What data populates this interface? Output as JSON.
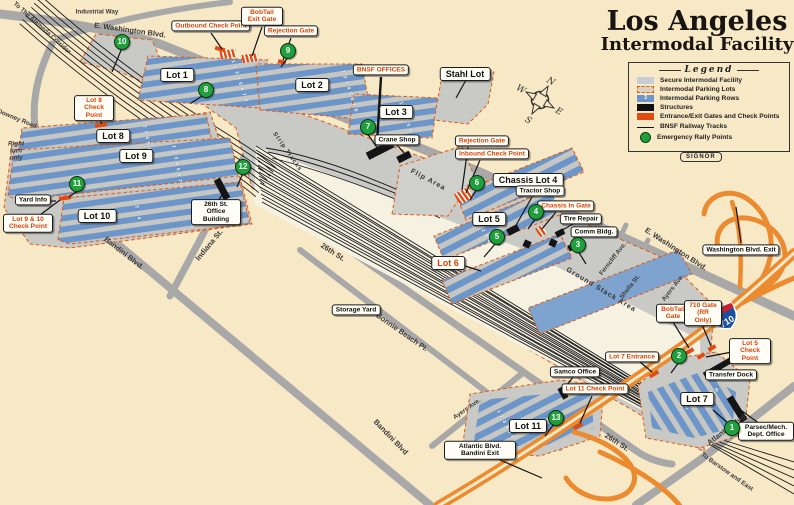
{
  "title": {
    "line1": "Los Angeles",
    "line2": "Intermodal Facility"
  },
  "legend": {
    "heading": "Legend",
    "badge": "SIGNOR",
    "items": [
      {
        "label": "Secure Intermodal Facility"
      },
      {
        "label": "Intermodal Parking Lots"
      },
      {
        "label": "Intermodal Parking Rows",
        "swatch_text": "3"
      },
      {
        "label": "Structures"
      },
      {
        "label": "Entrance/Exit Gates and Check Points"
      },
      {
        "label": "BNSF Railway Tracks"
      },
      {
        "label": "Emergency Rally Points"
      }
    ]
  },
  "compass": {
    "n": "N",
    "e": "E",
    "s": "S",
    "w": "W"
  },
  "freeway": {
    "shield": "710"
  },
  "streets": {
    "washington_top": "E. Washington Blvd.",
    "washington_right": "E. Washington Blvd.",
    "industrial_way": "Industrial Way",
    "downey": "Downey Road",
    "alameda": "To The Alameda Corridor",
    "bandini_left": "Bandini Blvd.",
    "bandini_bottom": "Bandini Blvd",
    "indiana": "Indiana St.",
    "st26_center": "26th St.",
    "st26_right": "26th St.",
    "bonnie": "Bonnie Beach Pl.",
    "ayers_right": "Ayers Ave.",
    "ayers_bottom": "Ayers Ave.",
    "ferncliff": "Ferncliff Ave.",
    "sheila": "Sheila St.",
    "atlantic": "Atlantic Blvd.",
    "barstow": "To Barstow and East",
    "right_turn": "Right turn only"
  },
  "lots": {
    "lot1": "Lot 1",
    "lot2": "Lot 2",
    "lot3": "Lot 3",
    "stahl": "Stahl Lot",
    "chassis4": "Chassis Lot 4",
    "lot5": "Lot 5",
    "lot6": "Lot 6",
    "lot7": "Lot 7",
    "lot8": "Lot 8",
    "lot9": "Lot 9",
    "lot10": "Lot 10",
    "lot11": "Lot 11"
  },
  "areas": {
    "flip": "Flip Area",
    "ground_stack": "Ground Stack Area",
    "strip_tracks": "Strip Tracks",
    "storage_yard": "Storage Yard"
  },
  "callouts_red": {
    "outbound": "Outbound Check Point",
    "bobtail_exit": "BobTail Exit Gate",
    "rejection_top": "Rejection Gate",
    "bnsf_offices": "BNSF OFFICES",
    "rejection": "Rejection Gate",
    "inbound": "Inbound Check Point",
    "chassis_in": "Chassis In Gate",
    "lot8_cp": "Lot 8 Check Point",
    "lot9_10_cp": "Lot 9 & 10 Check Point",
    "lot5_cp": "Lot 5 Check Point",
    "bobtail_gate": "BobTail Gate",
    "gate710": "710 Gate (RR Only)",
    "lot7_entrance": "Lot 7 Entrance",
    "lot11_cp": "Lot 11 Check Point"
  },
  "callouts_black": {
    "crane_shop": "Crane Shop",
    "tractor_shop": "Tractor Shop",
    "tire_repair": "Tire Repair",
    "comm_bldg": "Comm Bldg.",
    "washington_exit": "Washington Blvd. Exit",
    "transfer_dock": "Transfer Dock",
    "samco": "Samco Office",
    "atlantic_exit": "Atlantic Blvd. Bandini Exit",
    "parsec": "Parsec/Mech. Dept. Office",
    "office26": "26th St. Office Building",
    "yard_info": "Yard Info"
  },
  "rally_points": {
    "p1": "1",
    "p2": "2",
    "p3": "3",
    "p4": "4",
    "p5": "5",
    "p6": "6",
    "p7": "7",
    "p8": "8",
    "p9": "9",
    "p10": "10",
    "p11": "11",
    "p12": "12",
    "p13": "13"
  },
  "row_numbers": {
    "lot1": [
      "1",
      "2",
      "3",
      "4",
      "5",
      "6",
      "7",
      "8"
    ],
    "lot2": [
      "1",
      "2",
      "3",
      "4",
      "5",
      "6",
      "7",
      "8"
    ],
    "lot3": [
      "1",
      "2",
      "3",
      "4",
      "5",
      "6"
    ],
    "lot8": [
      "2",
      "3",
      "4",
      "5",
      "6",
      "7"
    ],
    "lot9": [
      "1",
      "2",
      "3",
      "4",
      "5",
      "6",
      "7",
      "8"
    ],
    "lot10": [
      "1",
      "2",
      "3",
      "4"
    ],
    "chassis4": [
      "1",
      "2",
      "3",
      "4"
    ],
    "lot5": [
      "1",
      "2",
      "3",
      "4"
    ],
    "lot7": [
      "1",
      "2",
      "3",
      "4",
      "5",
      "6",
      "7",
      "8"
    ],
    "lot11": [
      "1",
      "2",
      "3",
      "4",
      "5",
      "6"
    ]
  },
  "colors": {
    "background": "#F7E8C6",
    "accent_red": "#D8430A",
    "gate_red": "#E04B12",
    "rally_green": "#1FA03C",
    "row_blue": "#6C95C9",
    "freeway_orange": "#EC8A30",
    "street_gray": "#A8A8A8"
  }
}
